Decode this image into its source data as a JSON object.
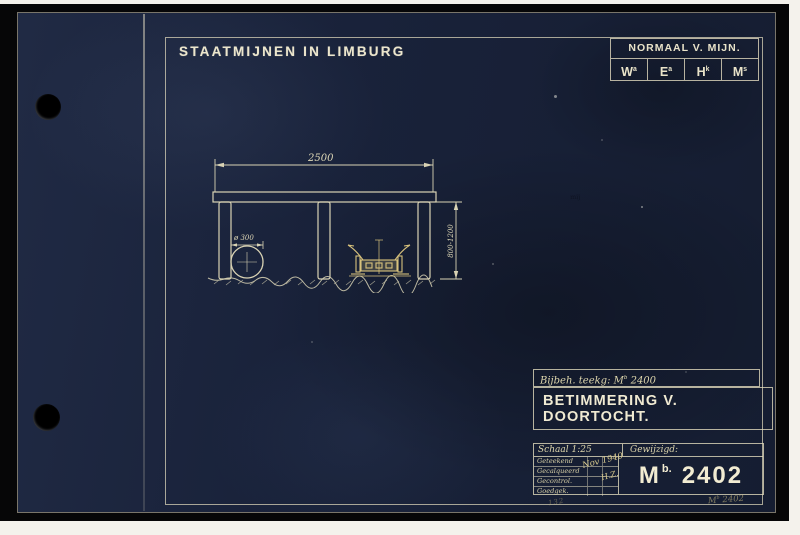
{
  "header": {
    "company": "STAATMIJNEN IN LIMBURG"
  },
  "normaal_table": {
    "title": "NORMAAL V. MIJN.",
    "cells": [
      {
        "base": "W",
        "sup": "a"
      },
      {
        "base": "E",
        "sup": "a"
      },
      {
        "base": "H",
        "sup": "k"
      },
      {
        "base": "M",
        "sup": "s"
      }
    ]
  },
  "drawing": {
    "dim_width": "2500",
    "dim_height": "800-1200",
    "dim_pipe": "ø 300"
  },
  "title_block": {
    "ref_label": "Bijbeh. teekg: M",
    "ref_sup": "b",
    "ref_number": " 2400",
    "title": "BETIMMERING V. DOORTOCHT.",
    "scale_label": "Schaal 1:25",
    "changed_label": "Gewijzigd:",
    "sign_rows": [
      "Geteekend",
      "Gecalqueerd",
      "Gecontrol.",
      "Goedgek."
    ],
    "handwritten_date": "Nov 1940",
    "handwritten_initials": "H.Z.",
    "number_prefix": "M",
    "number_sup": "b.",
    "number": "2402"
  },
  "margin_notes": {
    "corner_prefix": "M",
    "corner_sup": "b",
    "corner_number": " 2402",
    "scribble": "132",
    "smudge": "mij"
  },
  "colors": {
    "paper": "#1a2236",
    "line": "#d9d3b4",
    "title_text": "#f0ead2",
    "cart_yellow": "#d8c27c",
    "mat": "#060607"
  }
}
